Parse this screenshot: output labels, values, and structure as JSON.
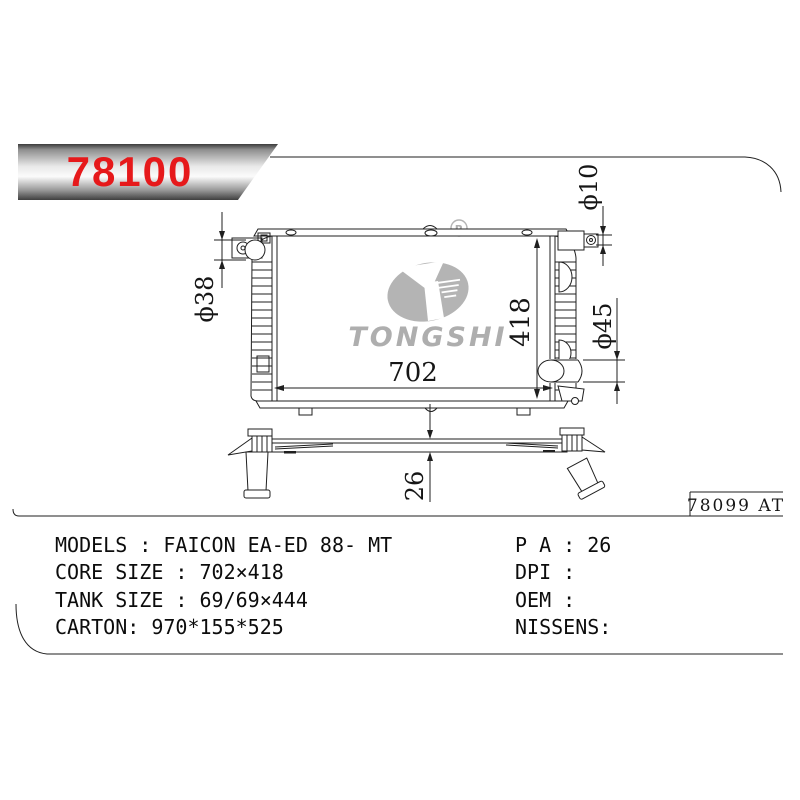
{
  "banner": {
    "part_number": "78100"
  },
  "frame": {
    "ref_code": "78099 AT"
  },
  "logo": {
    "brand": "TONGSHI",
    "registered_mark": "R"
  },
  "drawing": {
    "dim_core_width": "702",
    "dim_core_height": "418",
    "dim_core_thickness": "26",
    "dim_inlet": "ϕ38",
    "dim_outlet": "ϕ45",
    "dim_bracket_hole": "ϕ10"
  },
  "specs": {
    "left": [
      "MODELS : FAICON EA-ED 88- MT",
      "CORE SIZE : 702×418",
      "TANK SIZE : 69/69×444",
      "CARTON: 970*155*525"
    ],
    "right": [
      "P A : 26",
      "DPI :",
      "OEM :",
      "NISSENS:"
    ]
  },
  "colors": {
    "accent_red": "#e6191b",
    "watermark_gray": "#b4b4b4"
  }
}
